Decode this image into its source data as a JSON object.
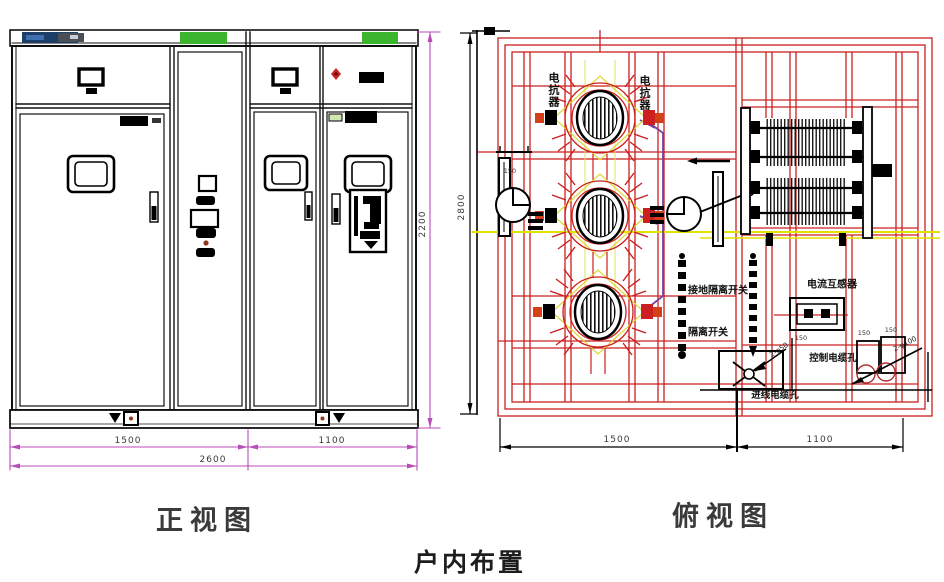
{
  "caption": "户内布置",
  "front_view": {
    "title": "正视图",
    "dim_left": "1500",
    "dim_right": "1100",
    "dim_total": "2600",
    "dim_height": "2200"
  },
  "top_view": {
    "title": "俯视图",
    "dim_left": "1500",
    "dim_right": "1100",
    "dim_depth": "2800",
    "labels": {
      "reactor_left": "电抗器",
      "reactor_right": "电抗器",
      "earthing_disconnector": "接地隔离开关",
      "disconnector": "隔离开关",
      "current_transformer": "电流互感器",
      "control_cable_hole": "控制电缆孔",
      "incoming_cable_hole": "进线电缆孔",
      "hole_dim_a": "150",
      "hole_dim_b": "150",
      "hole_dim_c": "150",
      "hole_dim_d": "150",
      "leader_left": "2-φ50",
      "leader_right": "2-φ100"
    }
  },
  "colors": {
    "line_red": "#cc2020",
    "dim_magenta": "#b84db8",
    "centerline_yellow": "#e2e200",
    "wire_purple": "#7a3fa0",
    "accent_green": "#3cb52e",
    "nameplate_navy": "#1b3f66"
  }
}
